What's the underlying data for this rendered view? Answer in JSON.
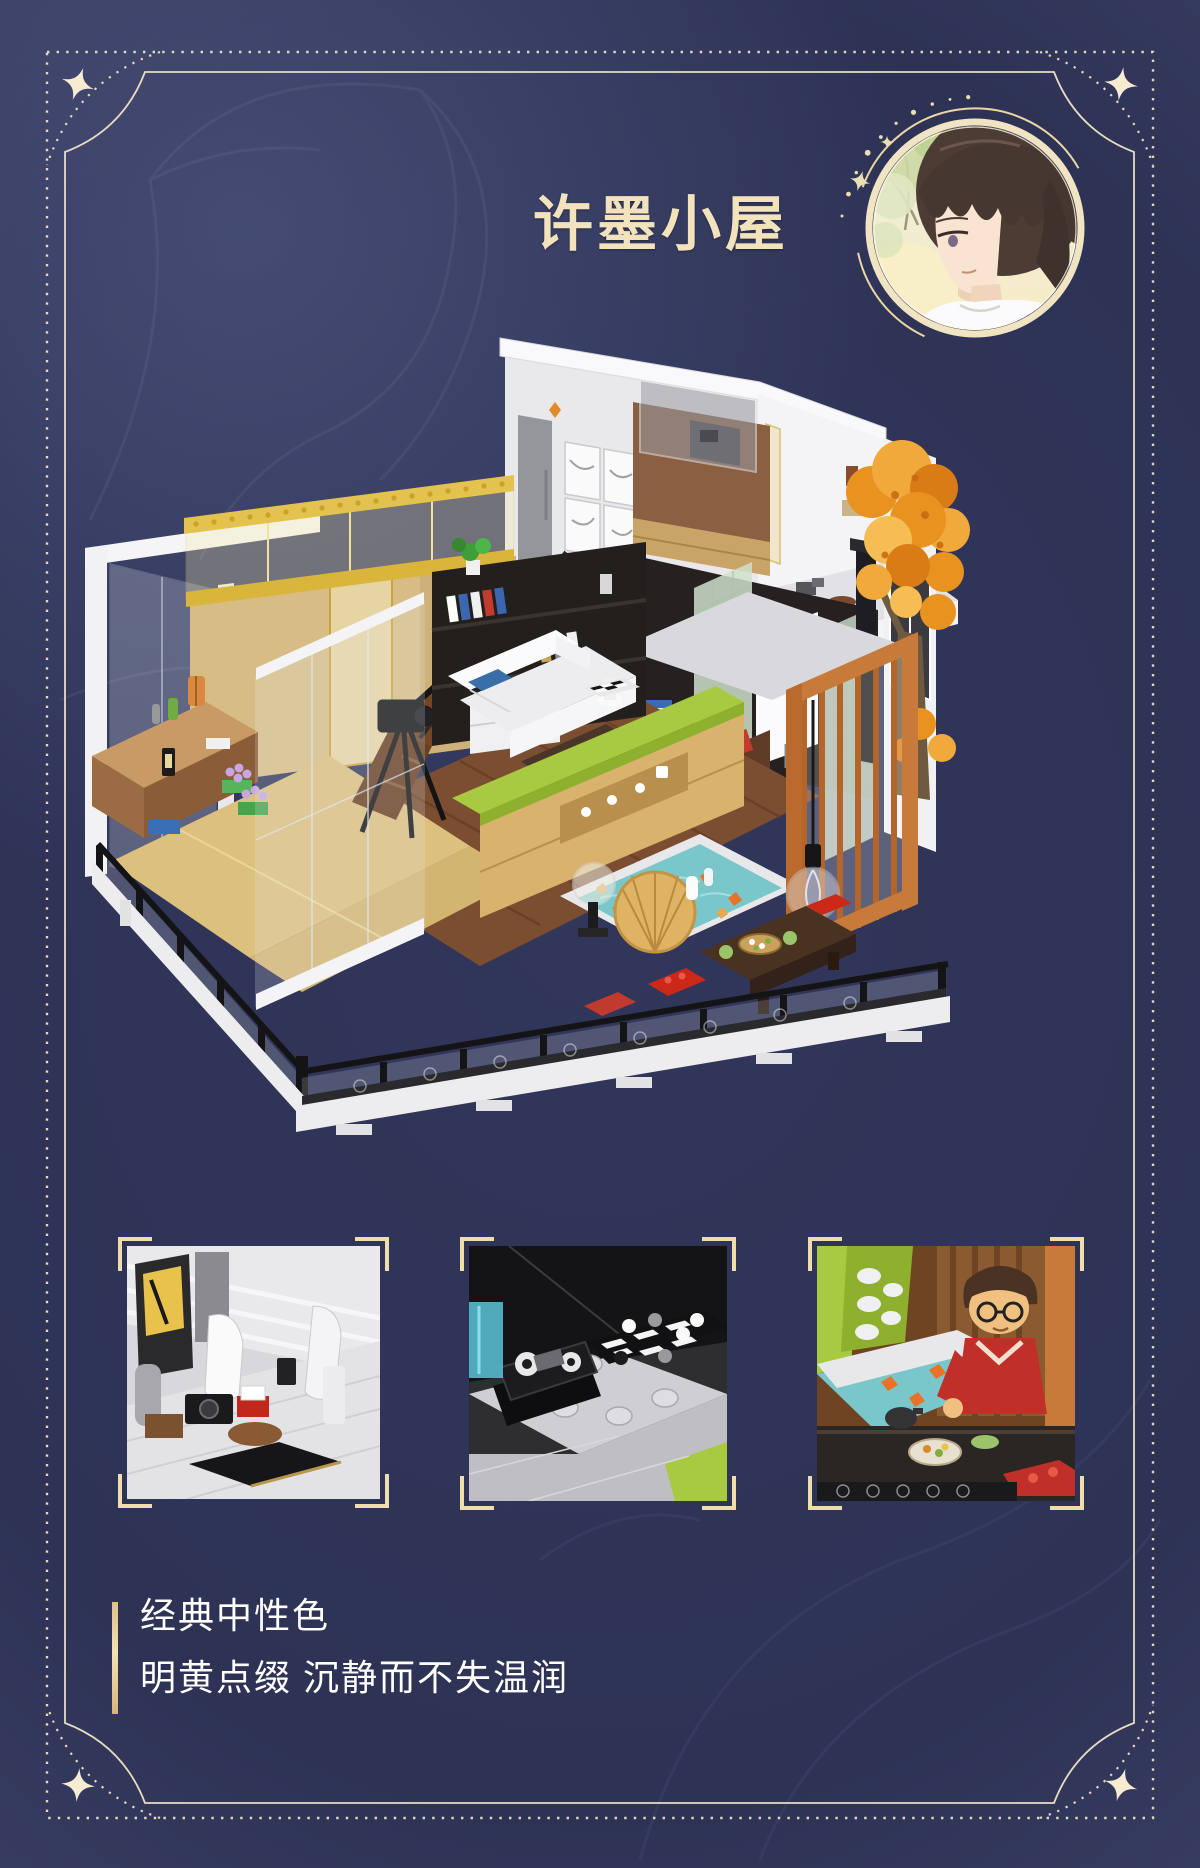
{
  "page": {
    "bg_outer": "#4a4f74",
    "bg_inner": "#2e3356",
    "frame_color": "#efe3c1",
    "corner_icon": "four-point-star"
  },
  "header": {
    "title": "许墨小屋",
    "title_color": "#f3e3bd",
    "avatar": {
      "alt": "许墨头像",
      "ring_color": "#f0e4c2",
      "sparkle_icon": "sparkle-stars-and-dots"
    }
  },
  "hero": {
    "alt": "许墨小屋积木场景照片",
    "palette": {
      "glass_gold_railing": "#e3c250",
      "wood_tan_wall": "#d7bd85",
      "walnut_floor": "#7b4e31",
      "autumn_orange": "#e8921f",
      "lime_green": "#a8ca41",
      "pond_teal": "#79c7ca",
      "screen_orange": "#c87a3a",
      "fence_black": "#141416"
    }
  },
  "details": [
    {
      "alt": "书桌与相机细节"
    },
    {
      "alt": "棋盘与遥控器细节"
    },
    {
      "alt": "人仔与茶座细节"
    }
  ],
  "caption": {
    "bar_color": "#ecd3a0",
    "text_color": "#ffffff",
    "line1": "经典中性色",
    "line2": "明黄点缀 沉静而不失温润"
  }
}
